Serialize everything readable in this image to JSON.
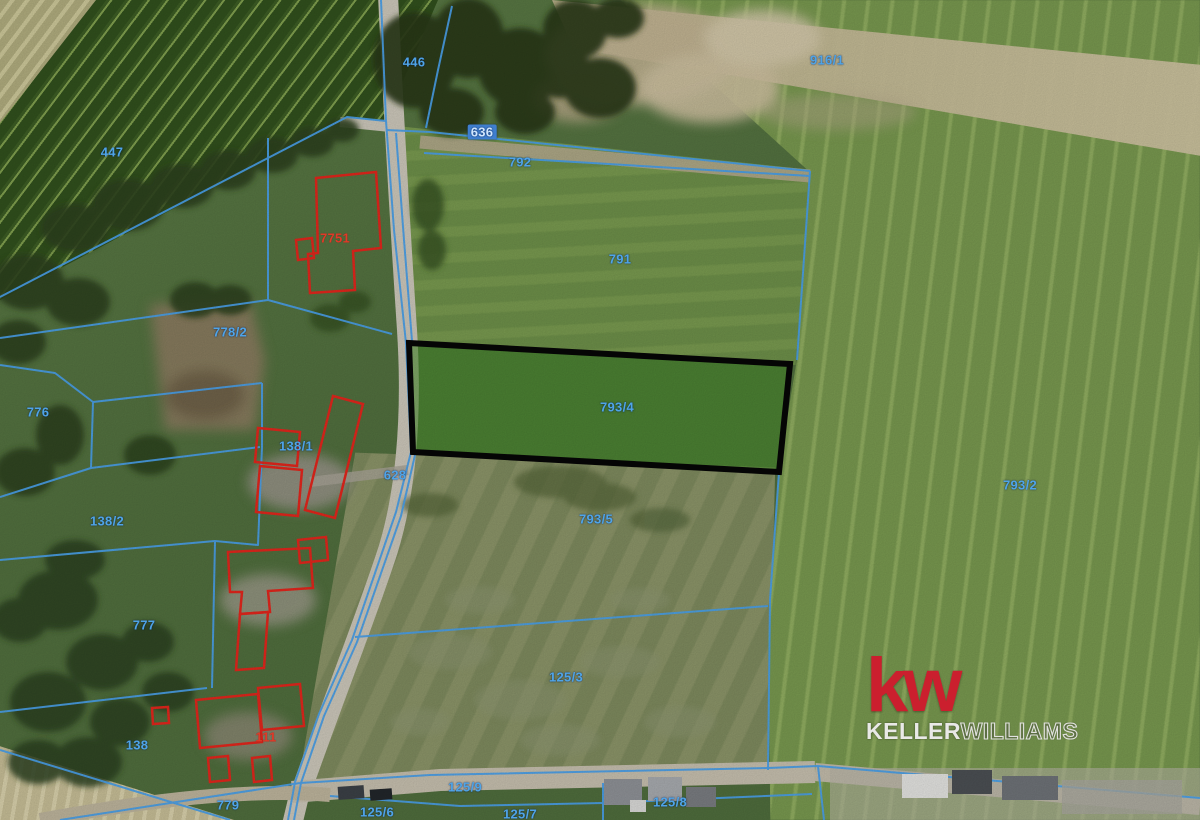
{
  "map": {
    "description": "Cadastral parcel overlay on aerial photo",
    "highlighted_parcel": {
      "number": "793/4",
      "fill": "#488c2c",
      "outline": "#060606"
    },
    "colors": {
      "parcel_line": "#4aa0e8",
      "building_outline": "#e2261c",
      "label_blue": "#4fa4e8",
      "label_red": "#e03a28",
      "highlight_fill": "#488c2c",
      "highlight_outline": "#060606"
    },
    "labels": [
      {
        "text": "447",
        "x": 112,
        "y": 152,
        "color": "blue"
      },
      {
        "text": "446",
        "x": 414,
        "y": 62,
        "color": "blue"
      },
      {
        "text": "916/1",
        "x": 827,
        "y": 60,
        "color": "blue"
      },
      {
        "text": "636",
        "x": 482,
        "y": 132,
        "color": "blue",
        "chip": true
      },
      {
        "text": "792",
        "x": 520,
        "y": 162,
        "color": "blue"
      },
      {
        "text": "791",
        "x": 620,
        "y": 259,
        "color": "blue"
      },
      {
        "text": "7751",
        "x": 335,
        "y": 238,
        "color": "red"
      },
      {
        "text": "778/2",
        "x": 230,
        "y": 332,
        "color": "blue"
      },
      {
        "text": "776",
        "x": 38,
        "y": 412,
        "color": "blue"
      },
      {
        "text": "138/1",
        "x": 296,
        "y": 446,
        "color": "blue"
      },
      {
        "text": "628",
        "x": 395,
        "y": 475,
        "color": "blue"
      },
      {
        "text": "138/2",
        "x": 107,
        "y": 521,
        "color": "blue"
      },
      {
        "text": "793/4",
        "x": 617,
        "y": 407,
        "color": "blue"
      },
      {
        "text": "793/5",
        "x": 596,
        "y": 519,
        "color": "blue"
      },
      {
        "text": "793/2",
        "x": 1020,
        "y": 485,
        "color": "blue"
      },
      {
        "text": "777",
        "x": 144,
        "y": 625,
        "color": "blue"
      },
      {
        "text": "125/3",
        "x": 566,
        "y": 677,
        "color": "blue"
      },
      {
        "text": "138",
        "x": 137,
        "y": 745,
        "color": "blue"
      },
      {
        "text": "111",
        "x": 266,
        "y": 737,
        "color": "red"
      },
      {
        "text": "779",
        "x": 228,
        "y": 805,
        "color": "blue"
      },
      {
        "text": "125/9",
        "x": 465,
        "y": 787,
        "color": "blue"
      },
      {
        "text": "125/6",
        "x": 377,
        "y": 812,
        "color": "blue"
      },
      {
        "text": "125/7",
        "x": 520,
        "y": 814,
        "color": "blue"
      },
      {
        "text": "125/8",
        "x": 670,
        "y": 802,
        "color": "blue"
      }
    ]
  },
  "logo": {
    "mark": "kw",
    "name_first": "KELLER",
    "name_second": "WILLIAMS",
    "brand_color": "#cb1f2e"
  }
}
